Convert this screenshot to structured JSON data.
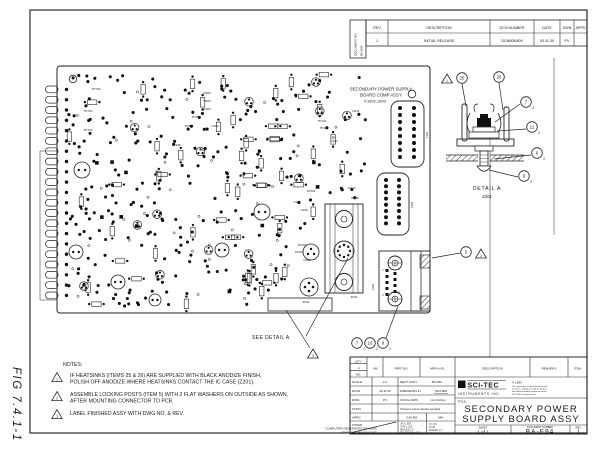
{
  "sheet": {
    "figure_label": "FIG 7.4.1-1"
  },
  "revision_table": {
    "doc_no_label": "DOCUMENT NO.",
    "doc_no_value": "BA-E94",
    "headers": [
      "REV",
      "DESCRIPTION",
      "DCN NUMBER",
      "DATE",
      "DWN",
      "APPD"
    ],
    "row": [
      "1",
      "INITIAL RELEASE",
      "DCN808/809",
      "93.11.30",
      "PV",
      ""
    ]
  },
  "board": {
    "silkscreen": [
      "SECONDARY POWER SUPPLY",
      "BOARD COMP ASSY",
      "©1992,1993"
    ],
    "see_detail": "SEE DETAIL A",
    "labels": [
      {
        "t": "TP702",
        "x": 96,
        "y": 90
      },
      {
        "t": "TP704",
        "x": 88,
        "y": 112
      },
      {
        "t": "TP703",
        "x": 88,
        "y": 131
      },
      {
        "t": "R362",
        "x": 207,
        "y": 94
      },
      {
        "t": "R363",
        "x": 207,
        "y": 102
      },
      {
        "t": "R364",
        "x": 207,
        "y": 110
      },
      {
        "t": "TP301",
        "x": 196,
        "y": 118
      },
      {
        "t": "TP304",
        "x": 189,
        "y": 127
      },
      {
        "t": "C302",
        "x": 215,
        "y": 127
      },
      {
        "t": "R338",
        "x": 177,
        "y": 146
      },
      {
        "t": "TP101",
        "x": 322,
        "y": 122
      },
      {
        "t": "TP104",
        "x": 324,
        "y": 129
      },
      {
        "t": "C304",
        "x": 334,
        "y": 142
      },
      {
        "t": "R311",
        "x": 356,
        "y": 112
      },
      {
        "t": "TP202",
        "x": 311,
        "y": 192
      },
      {
        "t": "R210",
        "x": 352,
        "y": 189
      },
      {
        "t": "R208",
        "x": 355,
        "y": 199
      },
      {
        "t": "C205",
        "x": 297,
        "y": 203
      },
      {
        "t": "C206",
        "x": 304,
        "y": 211
      },
      {
        "t": "TP203",
        "x": 302,
        "y": 246
      },
      {
        "t": "TP204",
        "x": 299,
        "y": 253
      },
      {
        "t": "C203",
        "x": 307,
        "y": 261
      },
      {
        "t": "Z202",
        "x": 306,
        "y": 303
      },
      {
        "t": "Z201",
        "x": 354,
        "y": 298
      },
      {
        "t": "J303",
        "x": 374,
        "y": 287,
        "rot": -90
      },
      {
        "t": "J301",
        "x": 428,
        "y": 135,
        "rot": -90
      },
      {
        "t": "J302",
        "x": 413,
        "y": 205,
        "rot": -90
      }
    ]
  },
  "detail_a": {
    "title": "DETAIL A",
    "subtitle": "Z201",
    "balloons": [
      {
        "n": "25",
        "x": 462,
        "y": 78
      },
      {
        "n": "26",
        "x": 499,
        "y": 77
      },
      {
        "n": "7",
        "q": "2",
        "x": 526,
        "y": 102
      },
      {
        "n": "11",
        "q": "2",
        "x": 532,
        "y": 127
      },
      {
        "n": "6",
        "q": "2",
        "x": 537,
        "y": 153
      },
      {
        "n": "9",
        "q": "2",
        "x": 524,
        "y": 176
      }
    ],
    "flags": [
      {
        "n": "1",
        "x": 447,
        "y": 79
      }
    ]
  },
  "callouts": {
    "balloons": [
      {
        "n": "5",
        "x": 466,
        "y": 252
      },
      {
        "n": "7",
        "q": "2",
        "x": 357,
        "y": 343
      },
      {
        "n": "10",
        "q": "2",
        "x": 370,
        "y": 343
      },
      {
        "n": "8",
        "q": "2",
        "x": 383,
        "y": 343
      }
    ],
    "flags": [
      {
        "n": "2",
        "x": 481,
        "y": 254
      },
      {
        "n": "3",
        "x": 313,
        "y": 354
      }
    ]
  },
  "notes": {
    "heading": "NOTES:",
    "items": [
      {
        "flag": "1",
        "lines": [
          "IF HEATSINKS (ITEMS 25 & 26) ARE SUPPLIED WITH BLACK ANODIZE FINISH,",
          "POLISH OFF ANODIZE WHERE HEATSINKS CONTACT THE IC CASE (Z201)."
        ]
      },
      {
        "flag": "2",
        "lines": [
          "ASSEMBLE LOCKING POSTS (ITEM 5) WITH 2 FLAT WASHERS ON OUTSIDE AS SHOWN,",
          "AFTER MOUNTING CONNECTOR TO PCB."
        ]
      },
      {
        "flag": "3",
        "lines": [
          "LABEL FINISHED ASSY WITH DWG NO. & REV.",
          ""
        ]
      }
    ]
  },
  "footer": {
    "line1": "COMPUTER GENERATED DRAWING",
    "line2": "FILENAME: BA-E94.DWG"
  },
  "title_block": {
    "parts": {
      "qty": "QTY",
      "dash": "-1",
      "no": "NO.",
      "um": "UM",
      "part_no": "PART NO.",
      "mfrs_no": "MFR's NO.",
      "description": "DESCRIPTION",
      "remarks": "REMARKS",
      "item": "ITEM"
    },
    "scale_label": "SCALE",
    "scale_value": "2:1",
    "next_assy_label": "NEXT ASSY.",
    "next_assy_value": "BA-051",
    "date_label": "DATE",
    "date_value": "93.11.30",
    "dims_label": "DIMENSIONS IN",
    "dims_value": "INCHES",
    "dwn_label": "DWN",
    "dwn_value": "PV",
    "dual_label": "IF DUAL DIMS.",
    "dual_value": "mm (Inches)",
    "chkd_label": "CHKD",
    "tol_note": "Tolerances (unless otherwise specified)",
    "appd_label": "APPD",
    "tol_in_header": "INCHES",
    "tol_mm_header": "MM",
    "finish_label": "FINISH",
    "tol_in": [
      ".XX ± .030",
      ".XXX ± .015",
      "ANGLES ± 1°",
      "FRACTIONS ± 1/32"
    ],
    "tol_mm": [
      ".X ± 0.8",
      "± 0.38",
      "ANGLES ± 1°"
    ],
    "brand": "SCI-TEC",
    "brand_sub": "INSTRUMENTS  INC.",
    "copyright": "© 1993",
    "legal_lines": [
      "This document is not to be disclosed",
      "to others, copied or used for produc-",
      "tion without written permission from",
      "SCI-TEC Instruments Inc."
    ],
    "title_label": "TITLE:",
    "title_lines": [
      "SECONDARY POWER",
      "SUPPLY BOARD ASSY"
    ],
    "sheet_label": "SHEET",
    "sheet_value": "1 of 1",
    "doc_label": "DOCUMENT NUMBER",
    "doc_value": "BA-E94",
    "rev_label": "REV.",
    "rev_value": "1"
  }
}
